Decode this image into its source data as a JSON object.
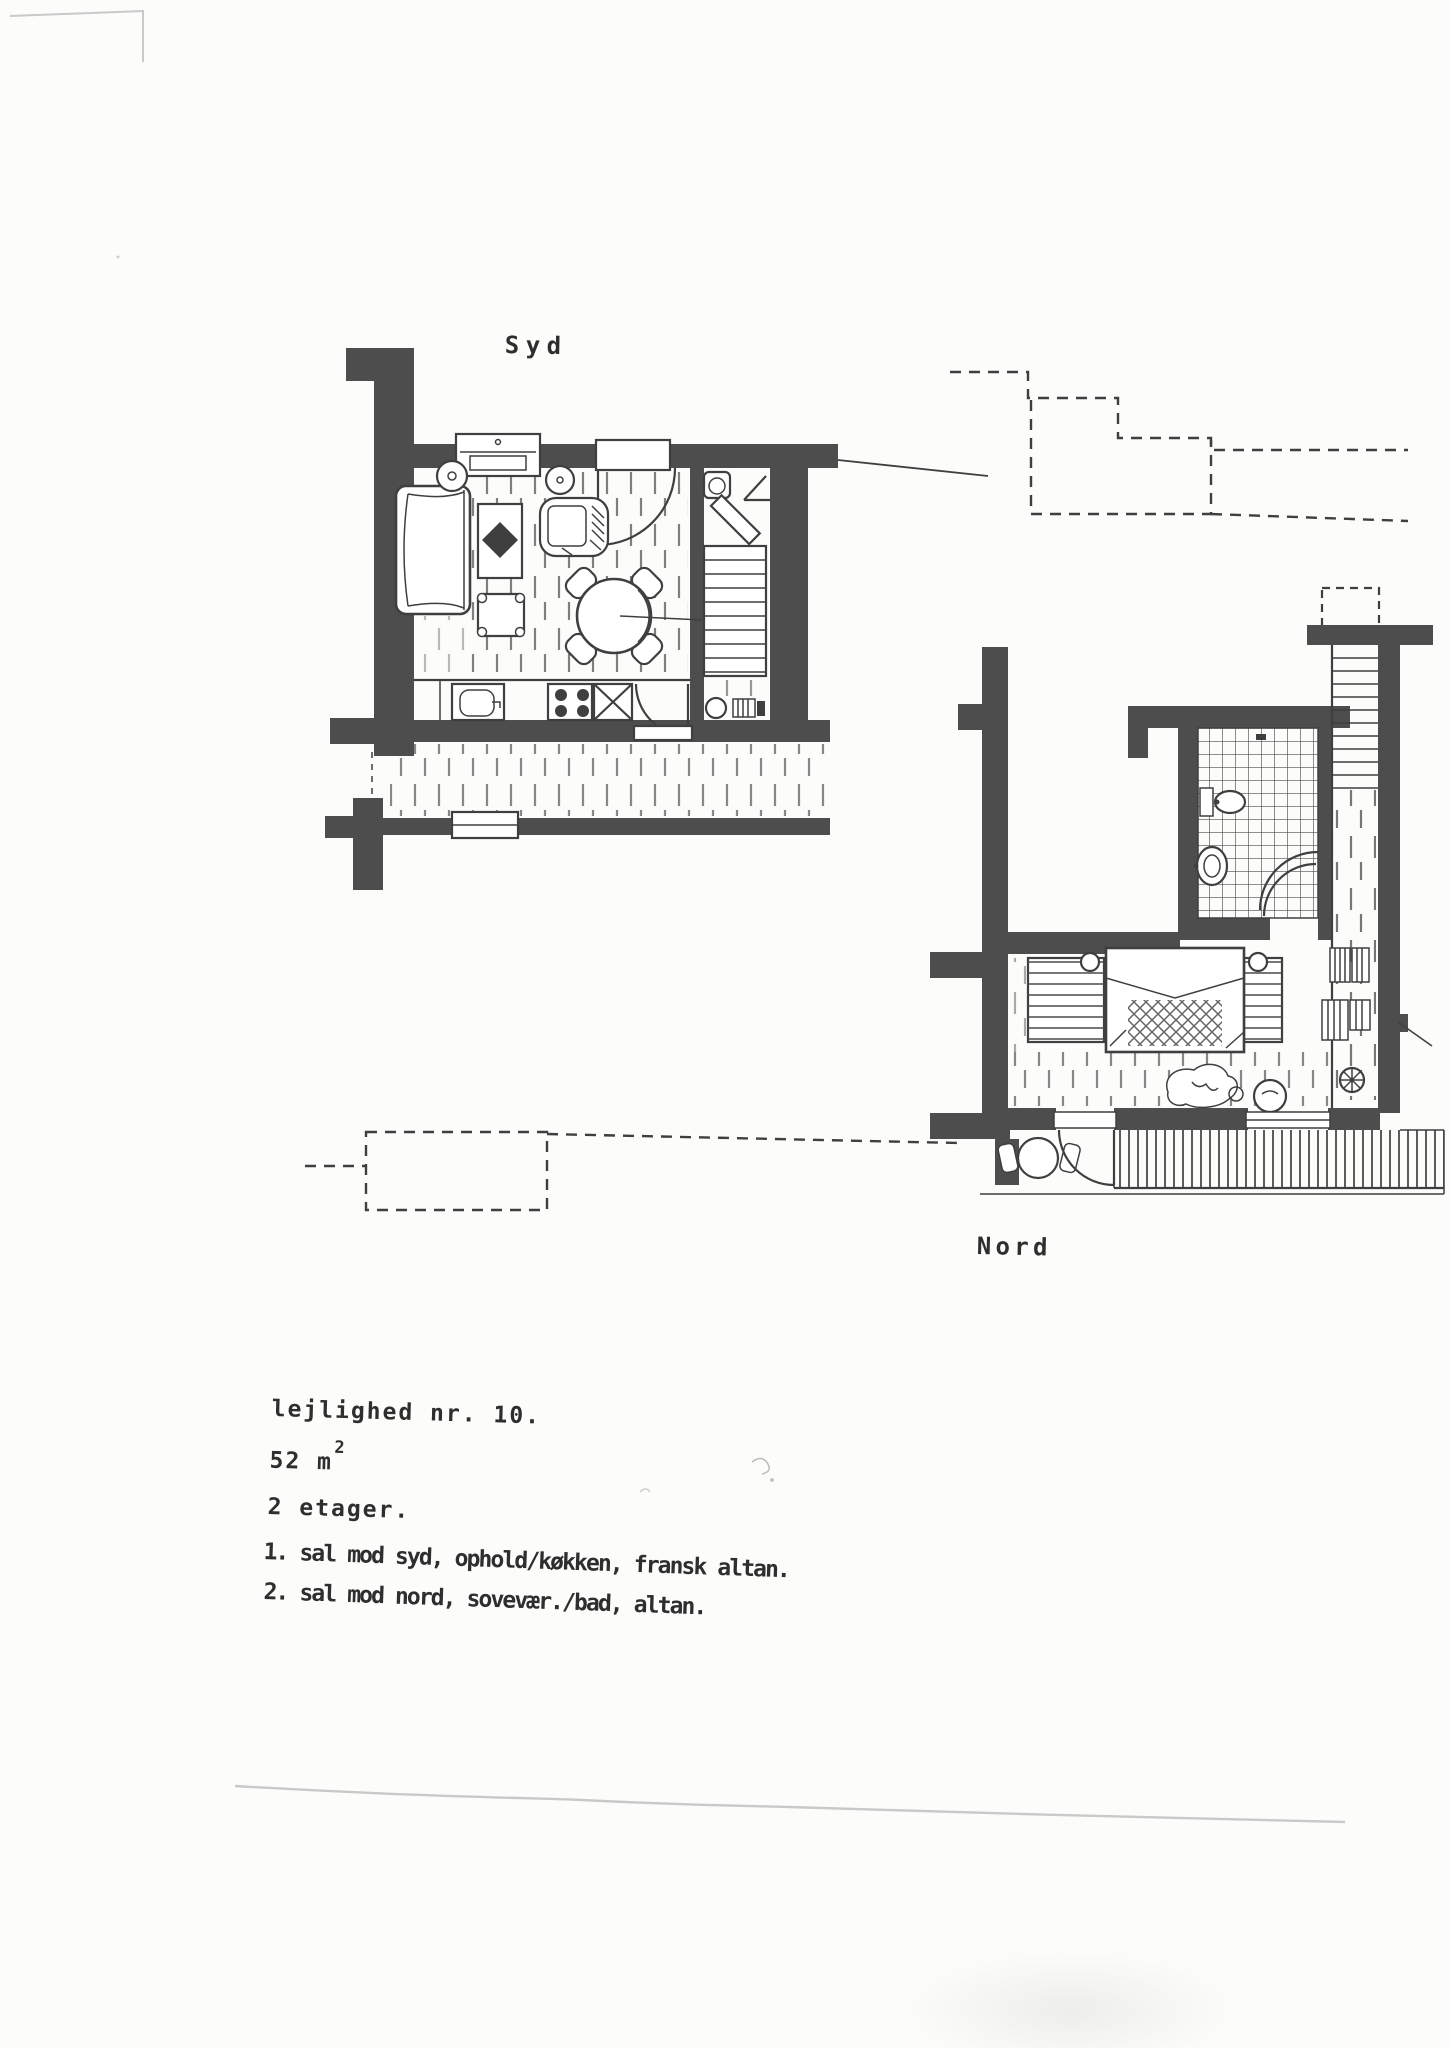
{
  "page": {
    "labels": {
      "syd": "Syd",
      "nord": "Nord"
    },
    "details": {
      "title": "lejlighed nr. 10.",
      "area_main": "52 m",
      "area_sup": "2",
      "floors": "2 etager.",
      "floor1": "1. sal mod syd, ophold/køkken, fransk altan.",
      "floor2": "2. sal mod nord, sovevær./bad, altan."
    },
    "colors": {
      "ink": "#3f3f3f",
      "wall": "#4d4d4d",
      "paper": "#fcfcfb",
      "faint": "#c9c9c9",
      "text": "#2e2e2e"
    }
  }
}
